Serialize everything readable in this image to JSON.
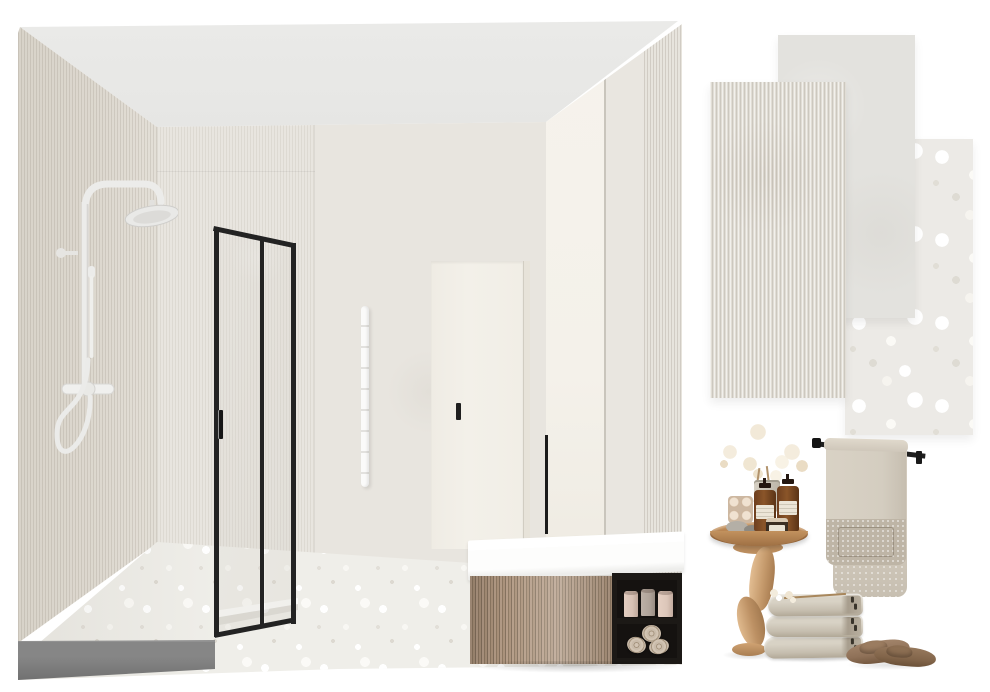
{
  "board": {
    "title": "bathroom-interior-design-moodboard",
    "background": "#ffffff",
    "sections": [
      "bathroom-3d-render",
      "tile-swatches",
      "accessory-photos"
    ]
  },
  "palette": {
    "page_bg": "#ffffff",
    "ceiling": "#eaeae8",
    "wall_stone": "#e8e5df",
    "wall_flute": "#ddd8cf",
    "wall_cream": "#f4f1ea",
    "wall_seam": "#c9c5bc",
    "floor_base": "#efeee9",
    "curb_dark": "#6f6f6f",
    "frame_black": "#232323",
    "fixture_white": "#efefed",
    "door_cream": "#f3f0e9",
    "radiator_white": "#fafaf9",
    "basin_white": "#fdfdfc",
    "wood_light": "#b49c87",
    "wood_dark": "#84715e",
    "shelf_black": "#1c1916",
    "candle_pink": "#d8c2b5",
    "candle_gray": "#b0a49a",
    "roll_beige": "#c9bbaa",
    "tile_plain": "#e3e2de",
    "tile_flute": "#e1ddd5",
    "tile_terrazzo": "#eceae6",
    "towel_light": "#d4cdc0",
    "towel_mid": "#c7bfb1",
    "towel_dark": "#beb5a6",
    "table_wood": "#b5814f",
    "pedestal_wood": "#c59a6c",
    "bottle_amber": "#8a5529",
    "slipper_tan": "#8f7158",
    "flower_cream": "#f4ecdd"
  },
  "render": {
    "label": "bathroom-3d-render",
    "elements": [
      "ribbed-accent-wall",
      "stone-back-wall",
      "cream-right-wall",
      "ceiling",
      "terrazzo-floor",
      "dark-gray-shower-curb",
      "white-rain-shower-column",
      "black-framed-glass-shower",
      "white-towel-radiator",
      "cream-flush-door",
      "black-stick-faucet",
      "white-countertop-basin",
      "fluted-oak-vanity-drawer",
      "black-open-shelf",
      "ceramic-vessels",
      "rolled-towels"
    ]
  },
  "tiles": [
    {
      "name": "ribbed-stone-tile-swatch",
      "color": "#e1ddd5"
    },
    {
      "name": "smooth-stone-tile-swatch",
      "color": "#e3e2de"
    },
    {
      "name": "terrazzo-stone-tile-swatch",
      "color": "#eceae6"
    }
  ],
  "decor": {
    "items": [
      "wooden-pedestal-side-table",
      "babys-breath-bouquet",
      "ceramic-vase",
      "bubble-candle",
      "amber-pump-bottles",
      "cream-jar",
      "pebbles",
      "black-towel-rail",
      "hanging-beige-towel",
      "stacked-folded-towels",
      "dried-sprig",
      "taupe-slippers"
    ]
  }
}
